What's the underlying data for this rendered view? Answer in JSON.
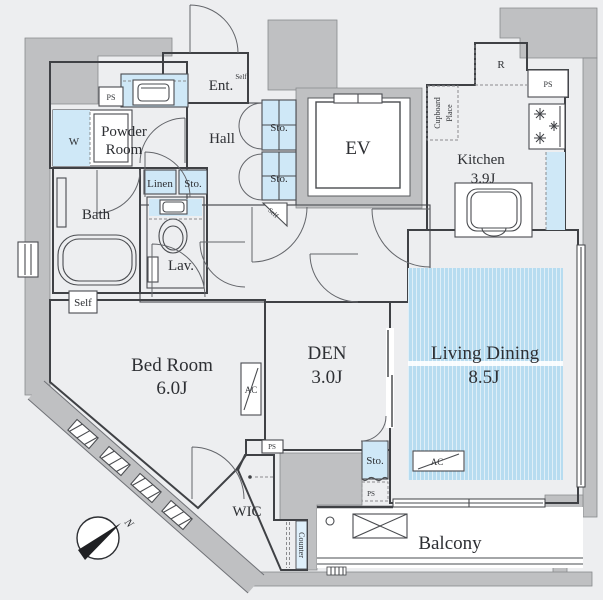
{
  "plan": {
    "rooms": {
      "entrance": {
        "label": "Ent."
      },
      "hall": {
        "label": "Hall"
      },
      "powder_room": {
        "line1": "Powder",
        "line2": "Room"
      },
      "bath": {
        "label": "Bath"
      },
      "lavatory": {
        "label": "Lav."
      },
      "bedroom": {
        "label": "Bed Room",
        "size": "6.0J"
      },
      "den": {
        "label": "DEN",
        "size": "3.0J"
      },
      "living_dining": {
        "label": "Living Dining",
        "size": "8.5J"
      },
      "kitchen": {
        "label": "Kitchen",
        "size": "3.9J"
      },
      "wic": {
        "label": "WIC"
      },
      "balcony": {
        "label": "Balcony"
      },
      "elevator": {
        "label": "EV"
      }
    },
    "labels": {
      "storage": "Sto.",
      "linen": "Linen",
      "washer": "W",
      "refrigerator": "R",
      "pipe_space": "PS",
      "self": "Self",
      "ac": "AC",
      "counter": "Counter",
      "cupboard_line1": "Cupboard",
      "cupboard_line2": "Place",
      "north": "N"
    },
    "colors": {
      "background": "#edeef0",
      "concrete_wall": "#bfc0c2",
      "fixture_blue": "#cfe8f7",
      "carpet_blue": "#b7dcf0",
      "wall_line": "#3f4145"
    }
  }
}
